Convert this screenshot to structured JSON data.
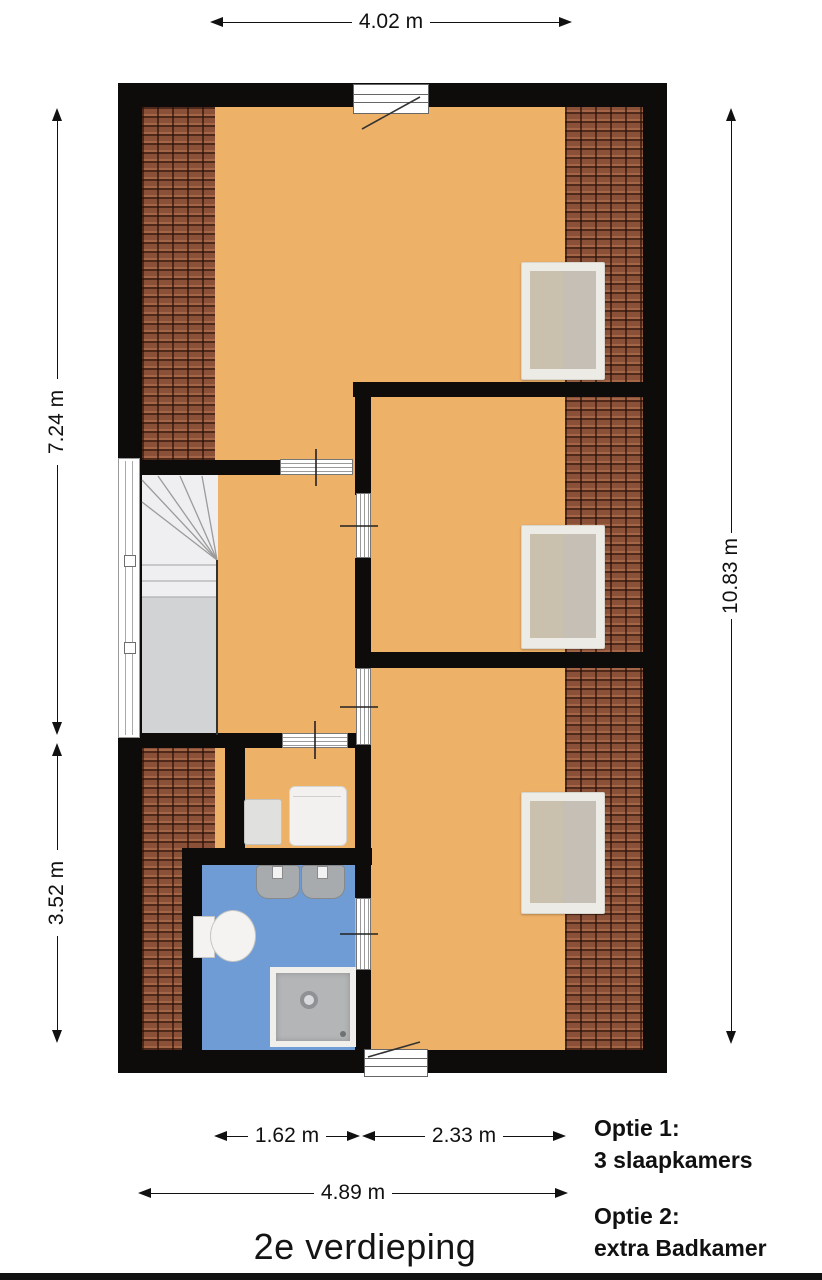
{
  "title": "2e verdieping",
  "dimensions": {
    "top": "4.02 m",
    "left_upper": "7.24 m",
    "left_lower": "3.52 m",
    "right": "10.83 m",
    "bottom_inner_left": "1.62 m",
    "bottom_inner_right": "2.33 m",
    "bottom_total": "4.89 m"
  },
  "options": {
    "option1_label": "Optie 1:",
    "option1_text": "3 slaapkamers",
    "option2_label": "Optie 2:",
    "option2_text": "extra Badkamer"
  },
  "colors": {
    "floor": "#eeb168",
    "roof_tiles": "#8a5138",
    "bathroom": "#6f9cd4",
    "walls": "#0e0c0a",
    "skylight_beige": "#c9c1ae"
  }
}
